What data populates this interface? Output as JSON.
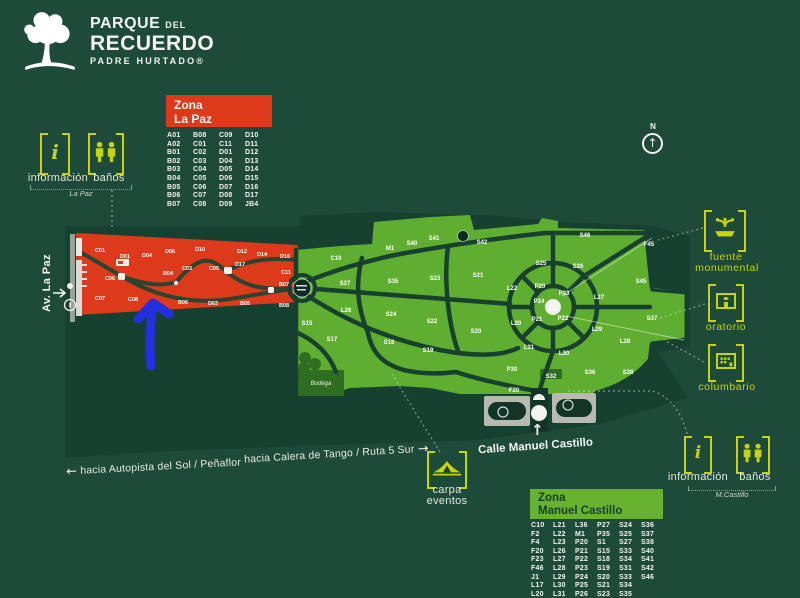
{
  "colors": {
    "background": "#1d4a39",
    "park_grounds": "#164030",
    "zone_la_paz_red": "#dc3a1b",
    "zone_manuel_castillo_green": "#5fae2f",
    "accent_lime": "#c5d40e",
    "road_dark_green": "#18402e",
    "legend_mc_header_green": "#67b32f",
    "annotation_blue": "#2330dd",
    "white": "#f4f4f0"
  },
  "logo": {
    "top": "PARQUE",
    "top_small": "DEL",
    "main": "RECUERDO",
    "sub": "PADRE HURTADO®"
  },
  "compass": {
    "north": "N",
    "arrow": "↑"
  },
  "legend_la_paz": {
    "zona": "Zona",
    "name": "La Paz",
    "codes": [
      [
        "A01",
        "B08",
        "C09",
        "D10"
      ],
      [
        "A02",
        "C01",
        "C11",
        "D11"
      ],
      [
        "B01",
        "C02",
        "D01",
        "D12"
      ],
      [
        "B02",
        "C03",
        "D04",
        "D13"
      ],
      [
        "B03",
        "C04",
        "D05",
        "D14"
      ],
      [
        "B04",
        "C05",
        "D06",
        "D15"
      ],
      [
        "B05",
        "C06",
        "D07",
        "D16"
      ],
      [
        "B06",
        "C07",
        "D08",
        "D17"
      ],
      [
        "B07",
        "C08",
        "D09",
        "JB4"
      ]
    ]
  },
  "legend_manuel_castillo": {
    "zona": "Zona",
    "name": "Manuel Castillo",
    "codes": [
      [
        "C10",
        "L21",
        "L36",
        "P27",
        "S24",
        "S36"
      ],
      [
        "F2",
        "L22",
        "M1",
        "P35",
        "S25",
        "S37"
      ],
      [
        "F4",
        "L23",
        "P20",
        "S1",
        "S27",
        "S38"
      ],
      [
        "F20",
        "L26",
        "P21",
        "S15",
        "S33",
        "S40"
      ],
      [
        "F23",
        "L27",
        "P22",
        "S18",
        "S34",
        "S41"
      ],
      [
        "F46",
        "L28",
        "P23",
        "S19",
        "S31",
        "S42"
      ],
      [
        "J1",
        "L29",
        "P24",
        "S20",
        "S33",
        "S46"
      ],
      [
        "L17",
        "L30",
        "P25",
        "S21",
        "S34",
        ""
      ],
      [
        "L20",
        "L31",
        "P26",
        "S23",
        "S35",
        ""
      ]
    ]
  },
  "services_la_paz": {
    "info_glyph": "i",
    "info": "información",
    "banos": "baños",
    "tag": "La Paz"
  },
  "services_m_castillo": {
    "info_glyph": "i",
    "info": "información",
    "banos": "baños",
    "tag": "M.Castillo"
  },
  "poi": {
    "fuente_1": "fuente",
    "fuente_2": "monumental",
    "oratorio": "oratorio",
    "columbario": "columbario",
    "carpa_1": "carpa",
    "carpa_2": "eventos"
  },
  "streets": {
    "av_la_paz": "Av. La Paz",
    "calle_manuel_castillo": "Calle Manuel Castillo",
    "entry_arrow": "↑"
  },
  "directions": {
    "west_arrow": "←",
    "west": "hacia Autopista del Sol / Peñaflor",
    "east": "hacia Calera de Tango / Ruta 5 Sur",
    "east_arrow": "→"
  },
  "map": {
    "bodega": "Bodega",
    "red_sector_labels": [
      {
        "t": "C01",
        "x": 100,
        "y": 252
      },
      {
        "t": "D01",
        "x": 125,
        "y": 258
      },
      {
        "t": "D04",
        "x": 147,
        "y": 257
      },
      {
        "t": "D06",
        "x": 170,
        "y": 253
      },
      {
        "t": "D10",
        "x": 200,
        "y": 251
      },
      {
        "t": "D12",
        "x": 242,
        "y": 253
      },
      {
        "t": "D14",
        "x": 262,
        "y": 256
      },
      {
        "t": "D16",
        "x": 285,
        "y": 258
      },
      {
        "t": "C06",
        "x": 110,
        "y": 280
      },
      {
        "t": "B04",
        "x": 168,
        "y": 275
      },
      {
        "t": "C03",
        "x": 187,
        "y": 270
      },
      {
        "t": "C05",
        "x": 214,
        "y": 270
      },
      {
        "t": "D17",
        "x": 240,
        "y": 266
      },
      {
        "t": "C11",
        "x": 286,
        "y": 274
      },
      {
        "t": "C07",
        "x": 100,
        "y": 300
      },
      {
        "t": "C08",
        "x": 133,
        "y": 301
      },
      {
        "t": "B06",
        "x": 183,
        "y": 304
      },
      {
        "t": "D03",
        "x": 213,
        "y": 305
      },
      {
        "t": "B05",
        "x": 245,
        "y": 305
      },
      {
        "t": "B07",
        "x": 284,
        "y": 286
      },
      {
        "t": "B08",
        "x": 284,
        "y": 307
      }
    ],
    "green_sector_labels": [
      {
        "t": "C10",
        "x": 336,
        "y": 260
      },
      {
        "t": "M1",
        "x": 390,
        "y": 250
      },
      {
        "t": "S40",
        "x": 412,
        "y": 245
      },
      {
        "t": "S41",
        "x": 434,
        "y": 240
      },
      {
        "t": "S42",
        "x": 482,
        "y": 244
      },
      {
        "t": "S46",
        "x": 585,
        "y": 237
      },
      {
        "t": "F45",
        "x": 649,
        "y": 246
      },
      {
        "t": "S45",
        "x": 641,
        "y": 283
      },
      {
        "t": "S27",
        "x": 345,
        "y": 285
      },
      {
        "t": "S35",
        "x": 393,
        "y": 283
      },
      {
        "t": "S23",
        "x": 435,
        "y": 280
      },
      {
        "t": "S21",
        "x": 478,
        "y": 277
      },
      {
        "t": "L26",
        "x": 346,
        "y": 312
      },
      {
        "t": "S24",
        "x": 391,
        "y": 316
      },
      {
        "t": "S22",
        "x": 432,
        "y": 323
      },
      {
        "t": "S20",
        "x": 476,
        "y": 333
      },
      {
        "t": "S15",
        "x": 307,
        "y": 325
      },
      {
        "t": "S17",
        "x": 332,
        "y": 341
      },
      {
        "t": "S18",
        "x": 389,
        "y": 344
      },
      {
        "t": "S19",
        "x": 428,
        "y": 352
      },
      {
        "t": "S25",
        "x": 541,
        "y": 265
      },
      {
        "t": "S26",
        "x": 578,
        "y": 268
      },
      {
        "t": "L22",
        "x": 512,
        "y": 290
      },
      {
        "t": "P20",
        "x": 540,
        "y": 288
      },
      {
        "t": "P23",
        "x": 564,
        "y": 295
      },
      {
        "t": "L27",
        "x": 599,
        "y": 299
      },
      {
        "t": "P24",
        "x": 539,
        "y": 303
      },
      {
        "t": "P21",
        "x": 537,
        "y": 321
      },
      {
        "t": "P22",
        "x": 563,
        "y": 320
      },
      {
        "t": "L20",
        "x": 516,
        "y": 325
      },
      {
        "t": "L29",
        "x": 597,
        "y": 331
      },
      {
        "t": "L31",
        "x": 529,
        "y": 349
      },
      {
        "t": "L30",
        "x": 564,
        "y": 355
      },
      {
        "t": "L28",
        "x": 625,
        "y": 343
      },
      {
        "t": "S37",
        "x": 652,
        "y": 320
      },
      {
        "t": "P30",
        "x": 512,
        "y": 371
      },
      {
        "t": "S32",
        "x": 551,
        "y": 378
      },
      {
        "t": "S36",
        "x": 590,
        "y": 374
      },
      {
        "t": "S38",
        "x": 628,
        "y": 374
      },
      {
        "t": "F20",
        "x": 514,
        "y": 392
      }
    ]
  }
}
